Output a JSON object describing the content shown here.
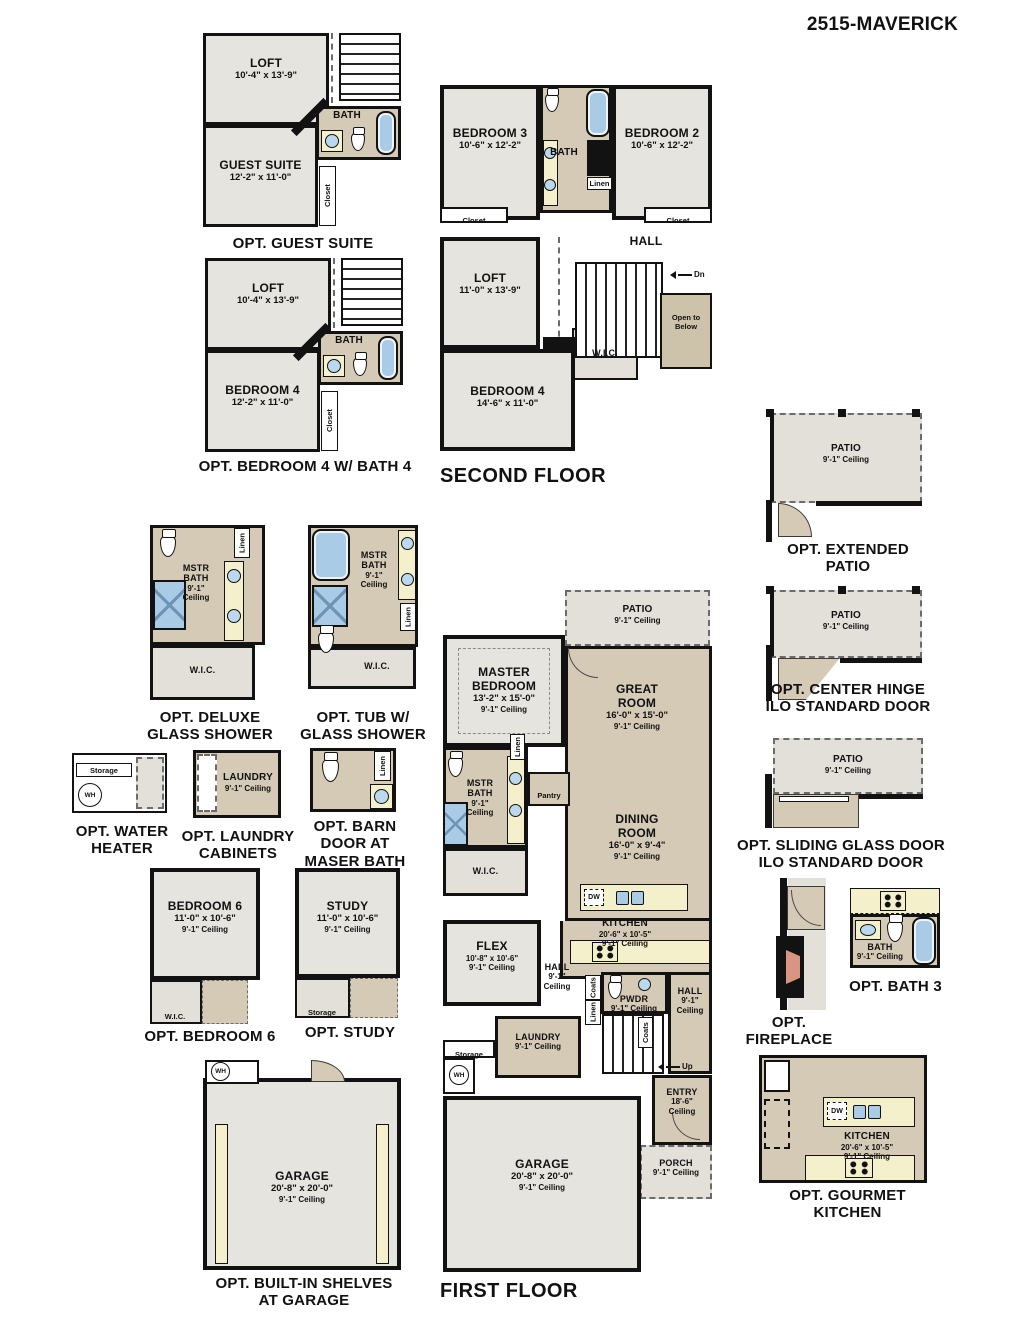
{
  "title": "2515-MAVERICK",
  "colors": {
    "room_gray": "#e6e4df",
    "room_tan": "#d4cab6",
    "patio_gray": "#e3e0da",
    "counter_cream": "#f4f0cb",
    "fixture_blue": "#a9cbe6",
    "fireplace_salmon": "#d89580",
    "wall_black": "#121212"
  },
  "plans": {
    "guest_suite": {
      "caption": "OPT. GUEST SUITE",
      "loft": {
        "name": "LOFT",
        "dim": "10'-4\" x 13'-9\""
      },
      "bath": {
        "name": "BATH"
      },
      "guest": {
        "name": "GUEST SUITE",
        "dim": "12'-2\" x 11'-0\""
      },
      "closet": "Closet"
    },
    "second_floor": {
      "caption": "SECOND FLOOR",
      "bedroom3": {
        "name": "BEDROOM 3",
        "dim": "10'-6\" x 12'-2\""
      },
      "bath": {
        "name": "BATH"
      },
      "bedroom2": {
        "name": "BEDROOM 2",
        "dim": "10'-6\" x 12'-2\""
      },
      "linen": "Linen",
      "closet_left": "Closet",
      "closet_right": "Closet",
      "hall": {
        "name": "HALL"
      },
      "dn": "Dn",
      "loft": {
        "name": "LOFT",
        "dim": "11'-0\" x 13'-9\""
      },
      "wic": "W.I.C.",
      "open_below": "Open to Below",
      "bedroom4": {
        "name": "BEDROOM 4",
        "dim": "14'-6\" x 11'-0\""
      }
    },
    "bedroom4_bath4": {
      "caption": "OPT. BEDROOM 4 W/ BATH 4",
      "loft": {
        "name": "LOFT",
        "dim": "10'-4\" x 13'-9\""
      },
      "bath": {
        "name": "BATH"
      },
      "bedroom": {
        "name": "BEDROOM 4",
        "dim": "12'-2\" x 11'-0\""
      },
      "closet": "Closet"
    },
    "extended_patio": {
      "caption1": "OPT. EXTENDED",
      "caption2": "PATIO",
      "patio": {
        "name": "PATIO",
        "ceil": "9'-1\" Ceiling"
      }
    },
    "center_hinge": {
      "caption1": "OPT. CENTER HINGE",
      "caption2": "ILO STANDARD DOOR",
      "patio": {
        "name": "PATIO",
        "ceil": "9'-1\" Ceiling"
      }
    },
    "deluxe_shower": {
      "caption1": "OPT. DELUXE",
      "caption2": "GLASS SHOWER",
      "bath": {
        "name": "MSTR BATH",
        "ceil1": "9'-1\"",
        "ceil2": "Ceiling"
      },
      "linen": "Linen",
      "wic": "W.I.C."
    },
    "tub_shower": {
      "caption1": "OPT. TUB W/",
      "caption2": "GLASS SHOWER",
      "bath": {
        "name": "MSTR BATH",
        "ceil1": "9'-1\"",
        "ceil2": "Ceiling"
      },
      "linen": "Linen",
      "wic": "W.I.C."
    },
    "water_heater": {
      "caption1": "OPT. WATER",
      "caption2": "HEATER",
      "storage": "Storage",
      "wh": "WH"
    },
    "laundry_cabinets": {
      "caption1": "OPT. LAUNDRY",
      "caption2": "CABINETS",
      "laundry": {
        "name": "LAUNDRY",
        "ceil": "9'-1\" Ceiling"
      }
    },
    "barn_door": {
      "caption1": "OPT. BARN",
      "caption2": "DOOR AT",
      "caption3": "MASER BATH",
      "linen": "Linen"
    },
    "sliding_glass": {
      "caption1": "OPT. SLIDING GLASS DOOR",
      "caption2": "ILO STANDARD DOOR",
      "patio": {
        "name": "PATIO",
        "ceil": "9'-1\" Ceiling"
      }
    },
    "bedroom6": {
      "caption": "OPT. BEDROOM 6",
      "room": {
        "name": "BEDROOM 6",
        "dim": "11'-0\" x 10'-6\"",
        "ceil": "9'-1\" Ceiling"
      },
      "wic": "W.I.C."
    },
    "study": {
      "caption": "OPT. STUDY",
      "room": {
        "name": "STUDY",
        "dim": "11'-0\" x 10'-6\"",
        "ceil": "9'-1\" Ceiling"
      },
      "storage": "Storage"
    },
    "first_floor": {
      "caption": "FIRST FLOOR",
      "patio": {
        "name": "PATIO",
        "ceil": "9'-1\" Ceiling"
      },
      "master": {
        "name": "MASTER BEDROOM",
        "dim": "13'-2\" x 15'-0\"",
        "ceil": "9'-1\" Ceiling"
      },
      "great": {
        "name": "GREAT ROOM",
        "dim": "16'-0\" x 15'-0\"",
        "ceil": "9'-1\" Ceiling"
      },
      "mstr_bath": {
        "name": "MSTR BATH",
        "ceil1": "9'-1\"",
        "ceil2": "Ceiling"
      },
      "linen_bath": "Linen",
      "pantry": "Pantry",
      "dining": {
        "name": "DINING ROOM",
        "dim": "16'-0\" x 9'-4\"",
        "ceil": "9'-1\" Ceiling"
      },
      "wic": "W.I.C.",
      "dw": "DW",
      "kitchen": {
        "name": "KITCHEN",
        "dim": "20'-6\" x 10'-5\"",
        "ceil": "9'-1\" Ceiling"
      },
      "flex": {
        "name": "FLEX",
        "dim": "10'-8\" x 10'-6\"",
        "ceil": "9'-1\" Ceiling"
      },
      "hall1": {
        "name": "HALL",
        "ceil1": "9'-1\"",
        "ceil2": "Ceiling"
      },
      "coats1": "Coats",
      "linen_hall": "Linen",
      "pwdr": {
        "name": "PWDR",
        "ceil": "9'-1\" Ceiling"
      },
      "hall2": {
        "name": "HALL",
        "ceil1": "9'-1\"",
        "ceil2": "Ceiling"
      },
      "laundry": {
        "name": "LAUNDRY",
        "ceil": "9'-1\" Ceiling"
      },
      "storage": "Storage",
      "wh": "WH",
      "coats2": "Coats",
      "up": "Up",
      "entry": {
        "name": "ENTRY",
        "ceil1": "18'-6\"",
        "ceil2": "Ceiling"
      },
      "porch": {
        "name": "PORCH",
        "ceil": "9'-1\" Ceiling"
      },
      "garage": {
        "name": "GARAGE",
        "dim": "20'-8\" x 20'-0\"",
        "ceil": "9'-1\" Ceiling"
      }
    },
    "fireplace": {
      "caption1": "OPT.",
      "caption2": "FIREPLACE"
    },
    "bath3": {
      "caption": "OPT. BATH 3",
      "bath": {
        "name": "BATH",
        "ceil": "9'-1\" Ceiling"
      }
    },
    "gourmet_kitchen": {
      "caption1": "OPT. GOURMET",
      "caption2": "KITCHEN",
      "kitchen": {
        "name": "KITCHEN",
        "dim": "20'-6\" x 10'-5\"",
        "ceil": "9'-1\" Ceiling"
      },
      "dw": "DW"
    },
    "builtin_shelves": {
      "caption1": "OPT. BUILT-IN SHELVES",
      "caption2": "AT GARAGE",
      "garage": {
        "name": "GARAGE",
        "dim": "20'-8\" x 20'-0\"",
        "ceil": "9'-1\" Ceiling"
      },
      "wh": "WH"
    }
  }
}
